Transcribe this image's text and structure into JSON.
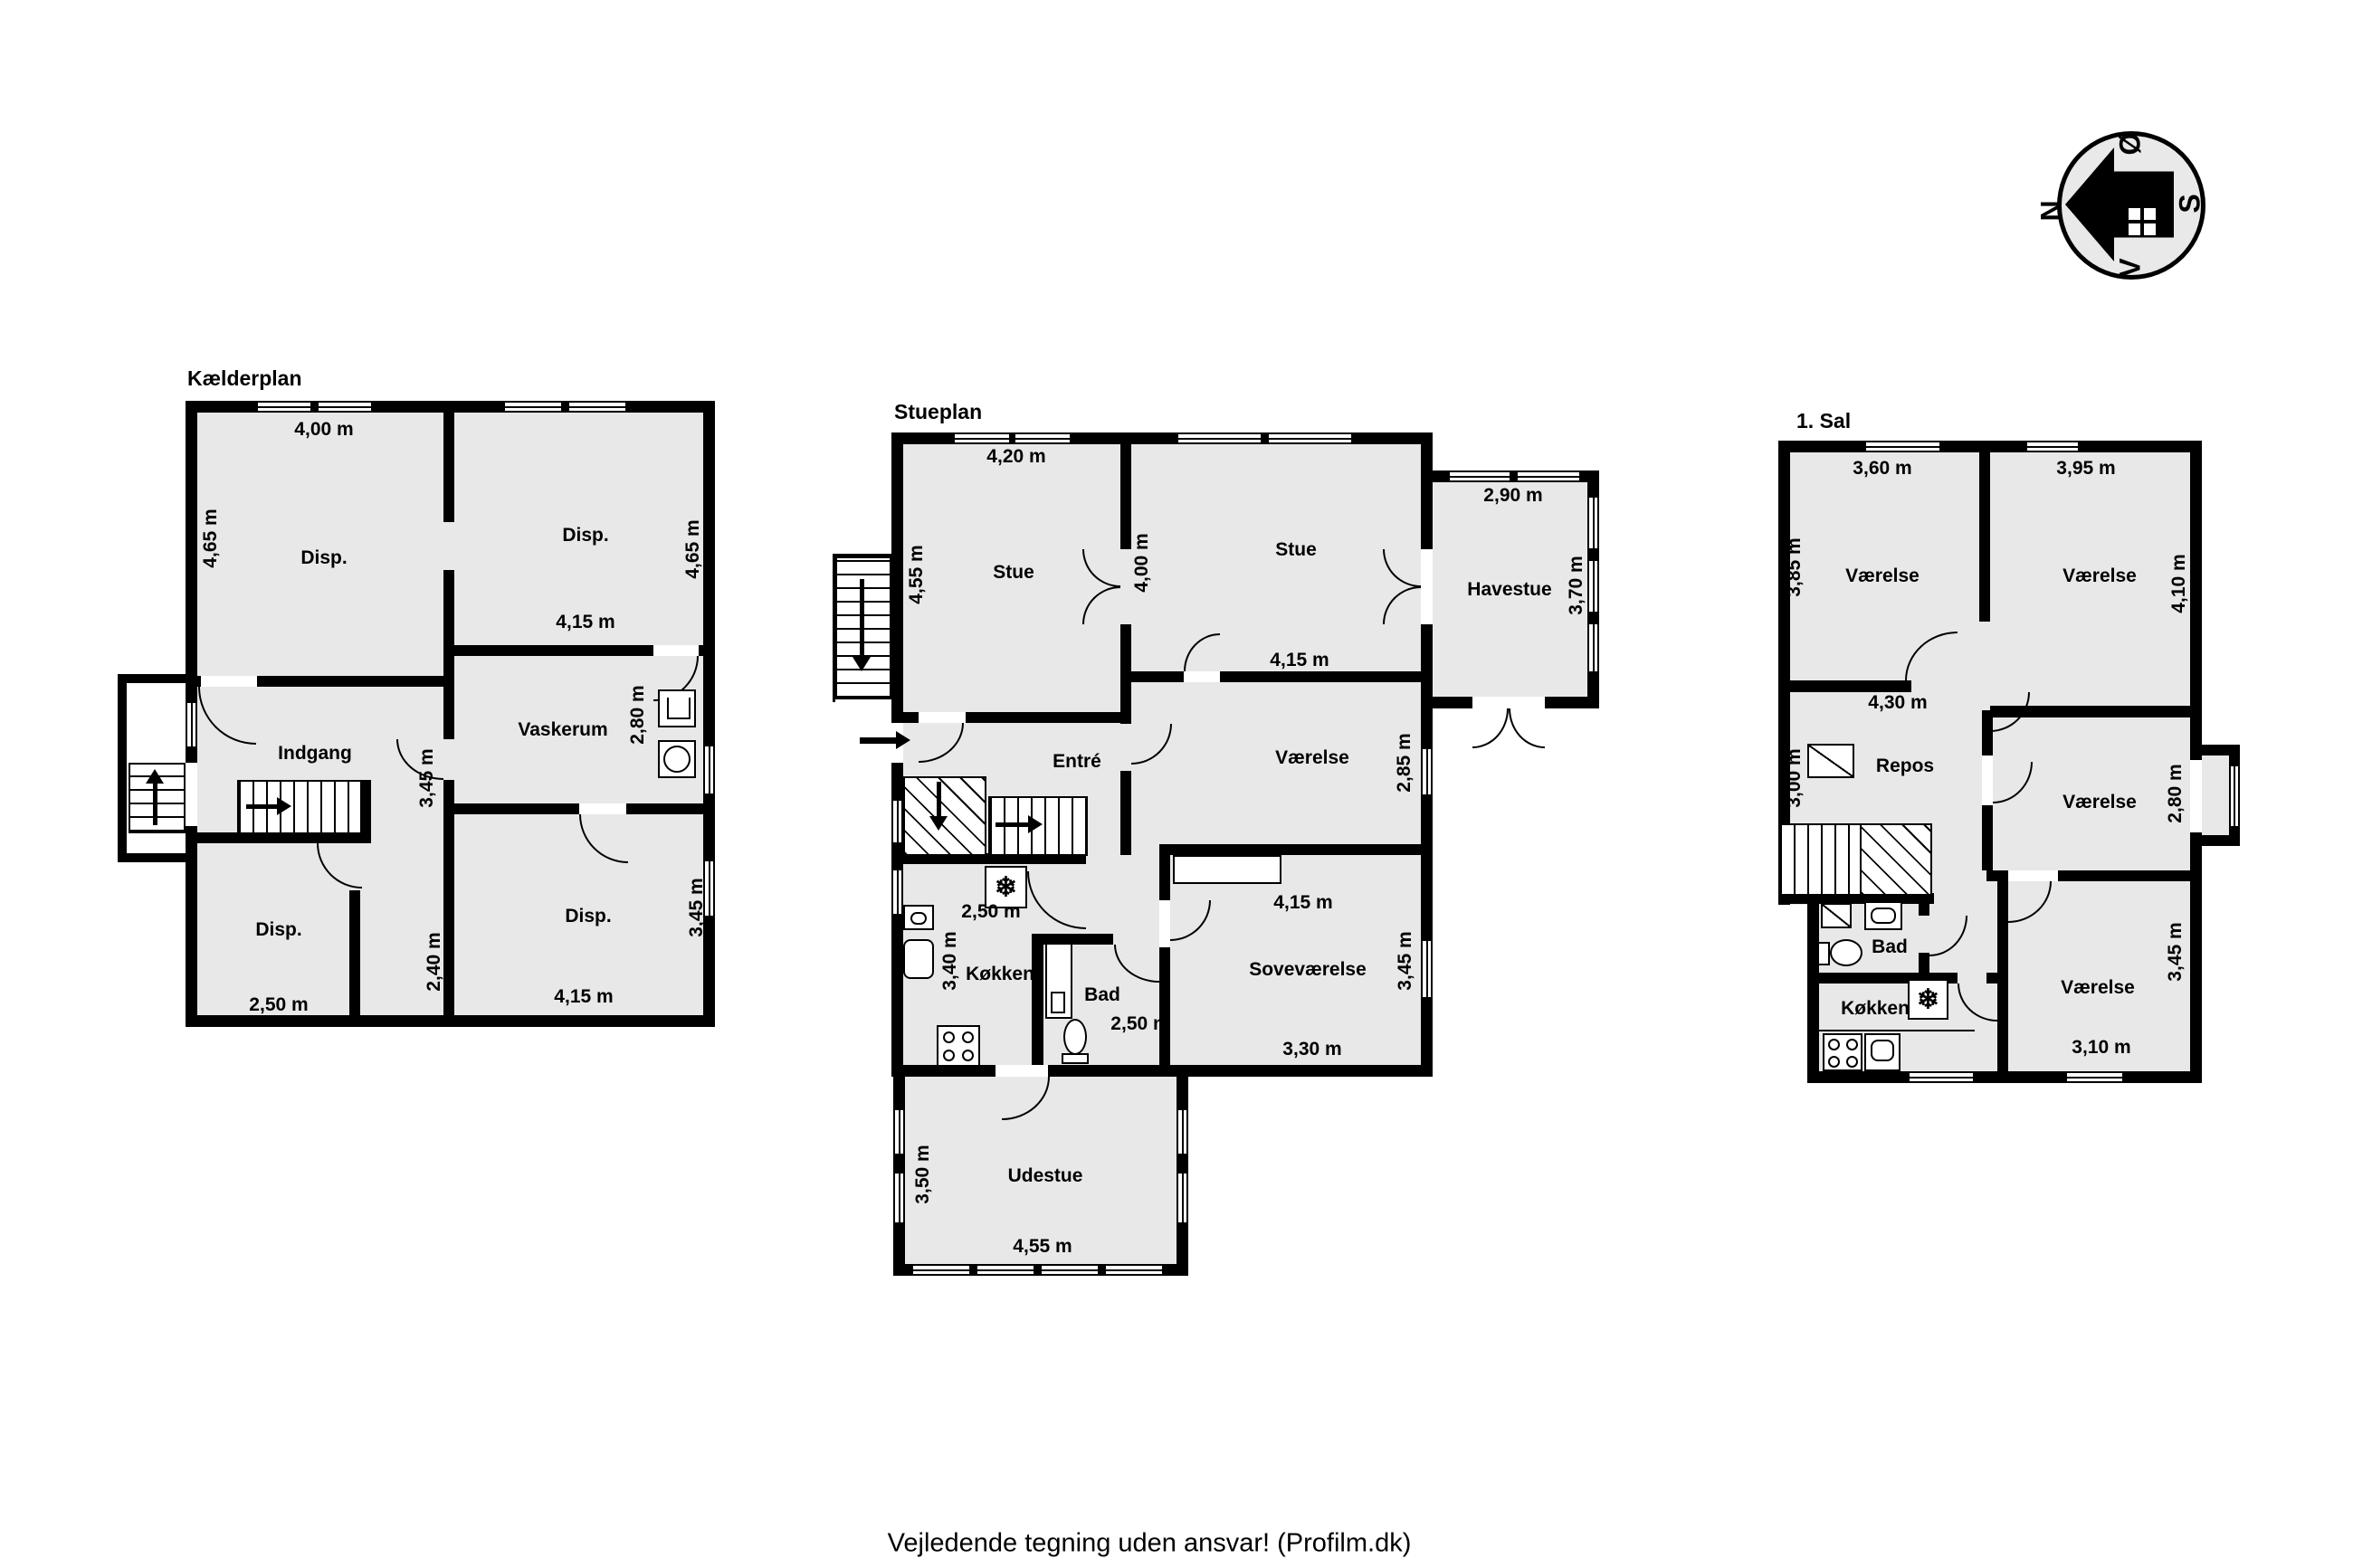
{
  "colors": {
    "wall": "#000000",
    "fill": "#e8e8e8",
    "bg": "#ffffff"
  },
  "icons": {
    "snowflake": "❄"
  },
  "compass": {
    "north": "N",
    "east": "Ø",
    "south": "S",
    "west": "V"
  },
  "footer": "Vejledende tegning uden ansvar! (Profilm.dk)",
  "basement": {
    "title": "Kælderplan",
    "rooms": {
      "disp_tl": "Disp.",
      "disp_tr": "Disp.",
      "indgang": "Indgang",
      "vaskerum": "Vaskerum",
      "disp_bl": "Disp.",
      "disp_br": "Disp."
    },
    "dims": {
      "tl_w": "4,00 m",
      "tl_h": "4,65 m",
      "tr_w": "4,15 m",
      "tr_h": "4,65 m",
      "mid_h": "3,45 m",
      "vask_h": "2,80 m",
      "bl_w": "2,50 m",
      "corr_h": "2,40 m",
      "br_w": "4,15 m",
      "br_h": "3,45 m"
    }
  },
  "ground": {
    "title": "Stueplan",
    "rooms": {
      "stue_l": "Stue",
      "stue_r": "Stue",
      "havestue": "Havestue",
      "entre": "Entré",
      "vaerelse": "Værelse",
      "koekken": "Køkken",
      "bad": "Bad",
      "sovevaerelse": "Soveværelse",
      "udestue": "Udestue"
    },
    "dims": {
      "stue_l_w": "4,20 m",
      "stue_l_h": "4,55 m",
      "stue_r_h": "4,00 m",
      "stue_r_w": "4,15 m",
      "havestue_w": "2,90 m",
      "havestue_h": "3,70 m",
      "vaerelse_h": "2,85 m",
      "vaerelse_w": "4,15 m",
      "koekken_w": "2,50 m",
      "koekken_h": "3,40 m",
      "bad_w": "2,50 m",
      "sove_h": "3,45 m",
      "sove_w": "3,30 m",
      "udestue_h": "3,50 m",
      "udestue_w": "4,55 m"
    }
  },
  "first": {
    "title": "1. Sal",
    "rooms": {
      "vaerelse_tl": "Værelse",
      "vaerelse_tr": "Værelse",
      "repos": "Repos",
      "vaerelse_mr": "Værelse",
      "bad": "Bad",
      "koekken": "Køkken",
      "vaerelse_br": "Værelse"
    },
    "dims": {
      "tl_w": "3,60 m",
      "tl_h": "3,85 m",
      "tr_w": "3,95 m",
      "tr_h": "4,10 m",
      "repos_w": "4,30 m",
      "repos_h": "3,00 m",
      "mr_h": "2,80 m",
      "br_h": "3,45 m",
      "br_w": "3,10 m"
    }
  }
}
